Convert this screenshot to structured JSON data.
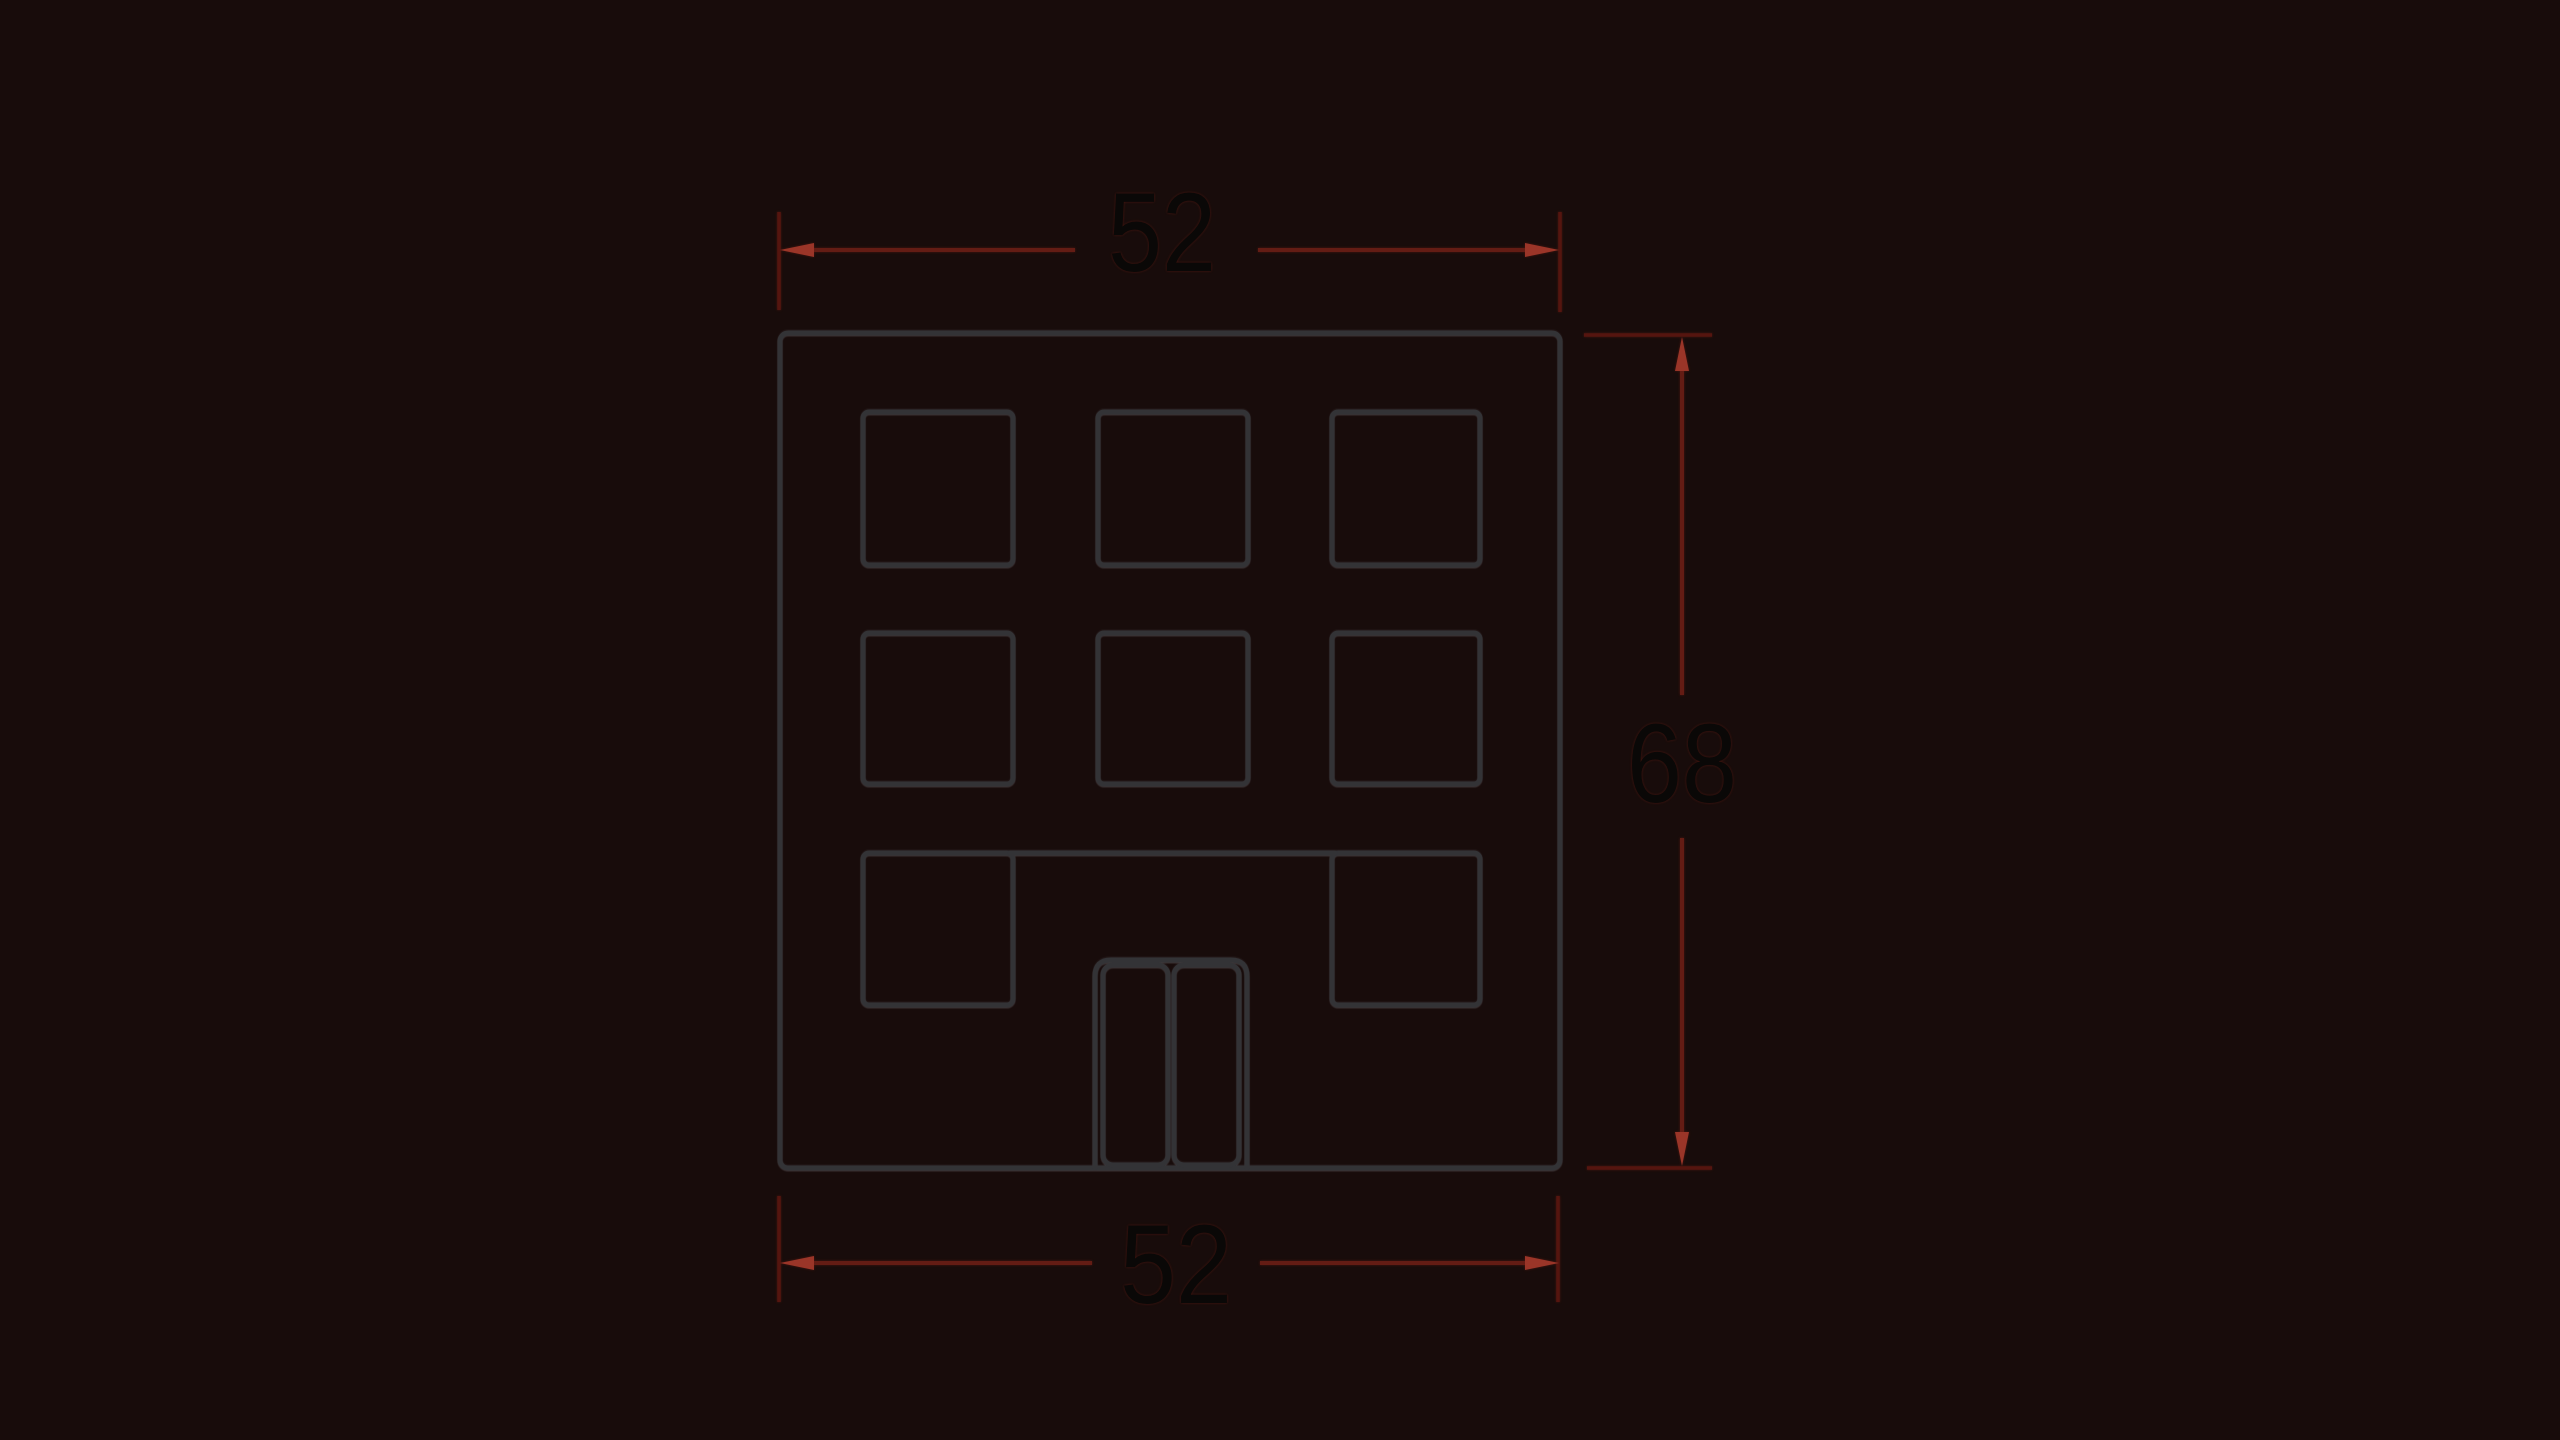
{
  "title": "Dimensioned building elevation drawing",
  "colors": {
    "background": "#180c0b",
    "outline": "#333336",
    "extension_line": "#55150f",
    "dimension_line": "#631c14",
    "arrowhead": "#9a3528",
    "label_text": "#0a0807"
  },
  "dimensions": {
    "top": {
      "label": "52"
    },
    "right": {
      "label": "68"
    },
    "bottom": {
      "label": "52"
    }
  },
  "building": {
    "window_rows": 3,
    "window_columns": 3,
    "windows_visible": 8,
    "door": "double-door"
  }
}
